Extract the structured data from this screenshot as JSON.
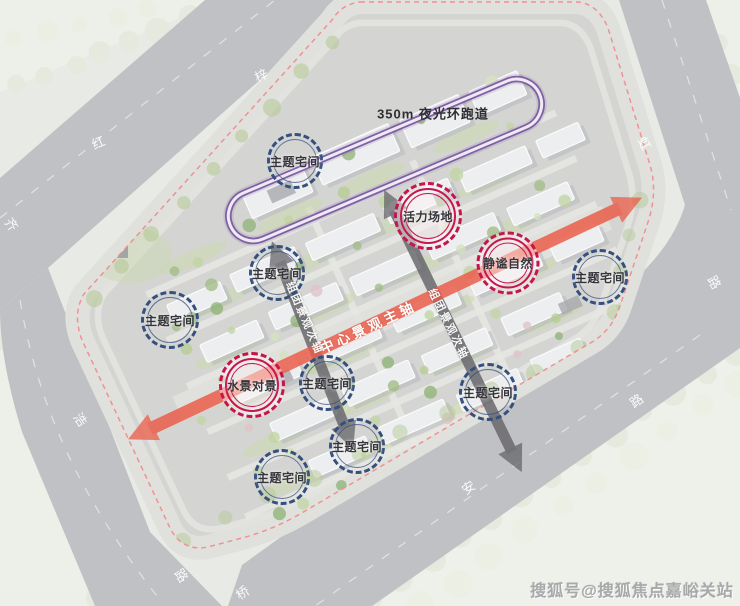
{
  "annotations": {
    "track": "350m 夜光环跑道",
    "main_axis": "中心景观主轴",
    "secondary_axis": "组团景观次轴"
  },
  "badges": [
    {
      "label": "主题宅间",
      "type": "blue",
      "x": 295,
      "y": 161,
      "size": 56
    },
    {
      "label": "主题宅间",
      "type": "blue",
      "x": 277,
      "y": 273,
      "size": 56
    },
    {
      "label": "主题宅间",
      "type": "blue",
      "x": 170,
      "y": 320,
      "size": 58
    },
    {
      "label": "主题宅间",
      "type": "blue",
      "x": 600,
      "y": 277,
      "size": 56
    },
    {
      "label": "主题宅间",
      "type": "blue",
      "x": 327,
      "y": 383,
      "size": 56
    },
    {
      "label": "主题宅间",
      "type": "blue",
      "x": 357,
      "y": 446,
      "size": 56
    },
    {
      "label": "主题宅间",
      "type": "blue",
      "x": 282,
      "y": 477,
      "size": 56
    },
    {
      "label": "主题宅间",
      "type": "blue",
      "x": 488,
      "y": 392,
      "size": 58
    },
    {
      "label": "活力场地",
      "type": "red",
      "x": 428,
      "y": 216,
      "size": 68
    },
    {
      "label": "静谧自然",
      "type": "red",
      "x": 508,
      "y": 263,
      "size": 63
    },
    {
      "label": "水景对景",
      "type": "red",
      "x": 252,
      "y": 385,
      "size": 66
    }
  ],
  "road_labels": [
    {
      "char": "梓",
      "x": 261,
      "y": 75,
      "rot": -24
    },
    {
      "char": "红",
      "x": 98,
      "y": 142,
      "rot": -24
    },
    {
      "char": "齐",
      "x": 12,
      "y": 224,
      "rot": 55
    },
    {
      "char": "浩",
      "x": 81,
      "y": 419,
      "rot": 55
    },
    {
      "char": "路",
      "x": 182,
      "y": 575,
      "rot": 55
    },
    {
      "char": "桥",
      "x": 242,
      "y": 592,
      "rot": -35
    },
    {
      "char": "安",
      "x": 468,
      "y": 487,
      "rot": -35
    },
    {
      "char": "路",
      "x": 636,
      "y": 400,
      "rot": -35
    },
    {
      "char": "虹",
      "x": 645,
      "y": 143,
      "rot": 60
    },
    {
      "char": "路",
      "x": 715,
      "y": 282,
      "rot": 60
    }
  ],
  "watermark": "搜狐号@搜狐焦点嘉峪关站",
  "colors": {
    "badge_blue": "#35507e",
    "badge_red": "#c4164e",
    "main_axis": "#eb5e4b",
    "secondary_axis": "#67676c",
    "track_purple": "#7a5aa0",
    "boundary_dash": "#ef8a89",
    "road_gray": "#c0c1c4"
  }
}
